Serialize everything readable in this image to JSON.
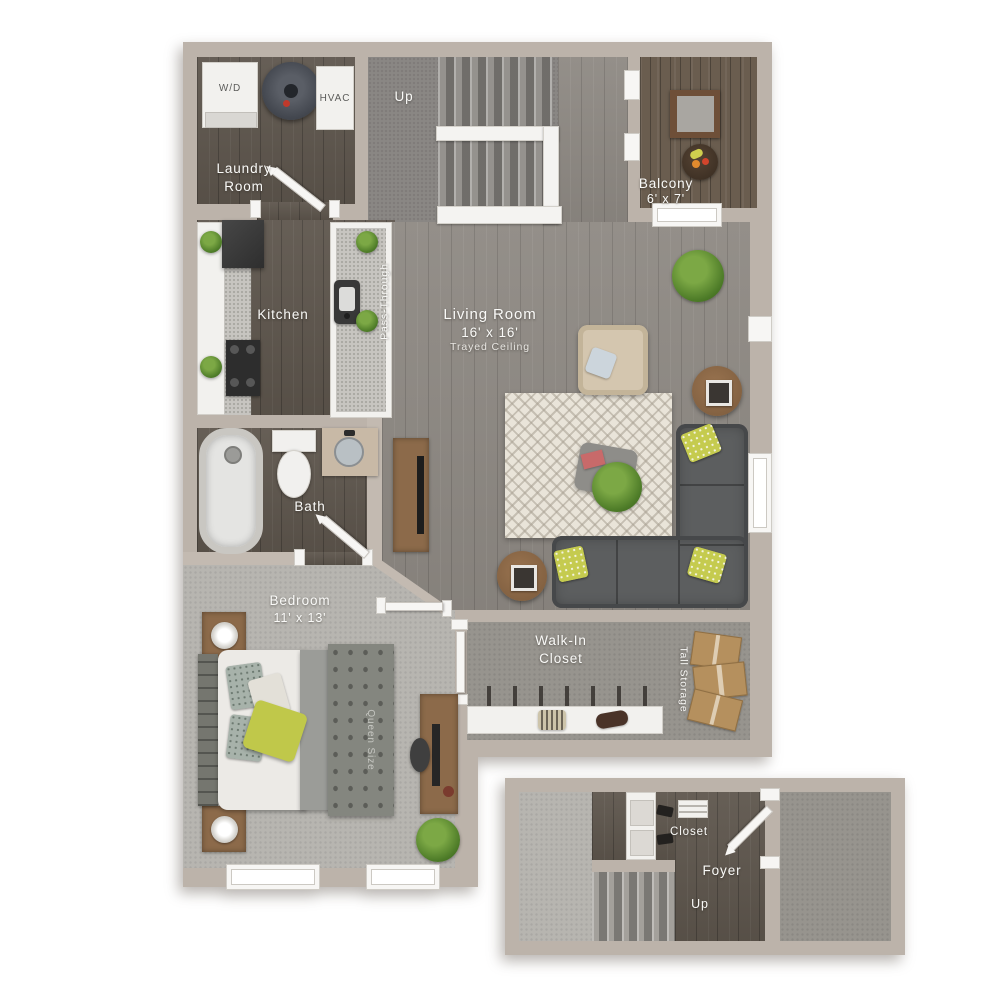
{
  "upper": {
    "laundry": {
      "label": "Laundry Room",
      "washer": "W/D",
      "hvac": "HVAC"
    },
    "stairs": {
      "label": "Up"
    },
    "balcony": {
      "label": "Balcony",
      "dims": "6' x 7'"
    },
    "kitchen": {
      "label": "Kitchen",
      "pass_through": "Pass-Through"
    },
    "living": {
      "label": "Living Room",
      "dims": "16' x 16'",
      "ceiling": "Trayed Ceiling"
    },
    "bath": {
      "label": "Bath"
    },
    "bedroom": {
      "label": "Bedroom",
      "dims": "11' x 13'",
      "bed": "Queen Size"
    },
    "walk_in_closet": {
      "label": "Walk-In Closet"
    },
    "tall_storage": {
      "label": "Tall Storage"
    }
  },
  "lower": {
    "closet": {
      "label": "Closet"
    },
    "foyer": {
      "label": "Foyer"
    },
    "stairs": {
      "label": "Up"
    }
  },
  "colors": {
    "wall": "#bcb3aa",
    "wood_light": "#8e8983",
    "wood_dark": "#5e564d",
    "wood_balcony": "#6a5d4f",
    "carpet_light": "#b7b5b0",
    "carpet_mid": "#97948e",
    "accent_pillow": "#c5cb4f",
    "trim_white": "#f7f6f4"
  }
}
